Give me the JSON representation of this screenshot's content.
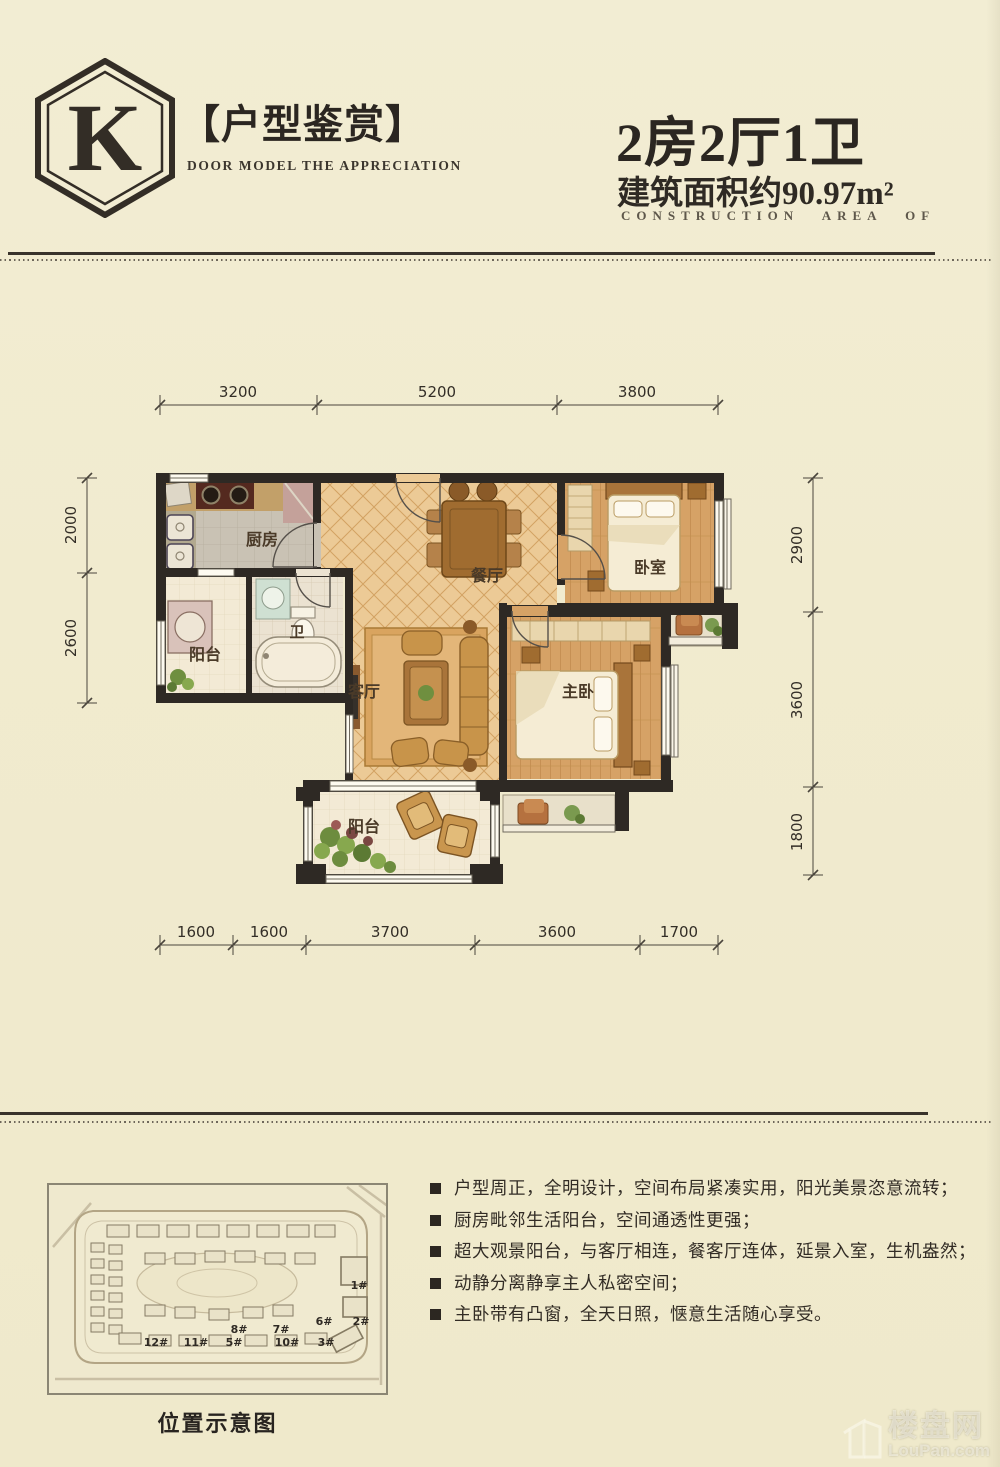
{
  "header": {
    "logo_letter": "K",
    "title": "【户型鉴赏】",
    "subtitle": "DOOR MODEL THE APPRECIATION",
    "unit_type": "2房2厅1卫",
    "area": "建筑面积约90.97m²",
    "area_en": "CONSTRUCTION AREA OF"
  },
  "floor_plan": {
    "rooms": {
      "kitchen": "厨房",
      "balcony_left": "阳台",
      "bath": "卫",
      "dining": "餐厅",
      "living": "客厅",
      "bedroom": "卧室",
      "master": "主卧",
      "balcony_bottom": "阳台"
    },
    "dims": {
      "top": [
        "3200",
        "5200",
        "3800"
      ],
      "bottom": [
        "1600",
        "1600",
        "3700",
        "3600",
        "1700"
      ],
      "left": [
        "2000",
        "2600"
      ],
      "right": [
        "2900",
        "3600",
        "1800"
      ]
    }
  },
  "site_map": {
    "caption": "位置示意图",
    "building_labels": [
      "1#",
      "2#",
      "6#",
      "8#",
      "7#",
      "12#",
      "11#",
      "5#",
      "10#",
      "3#"
    ]
  },
  "features": {
    "items": [
      "户型周正，全明设计，空间布局紧凑实用，阳光美景恣意流转；",
      "厨房毗邻生活阳台，空间通透性更强；",
      "超大观景阳台，与客厅相连，餐客厅连体，延景入室，生机盎然；",
      "动静分离静享主人私密空间；",
      "主卧带有凸窗，全天日照，惬意生活随心享受。"
    ]
  },
  "watermark": {
    "cn": "楼盘网",
    "en": "LouPan.com"
  }
}
